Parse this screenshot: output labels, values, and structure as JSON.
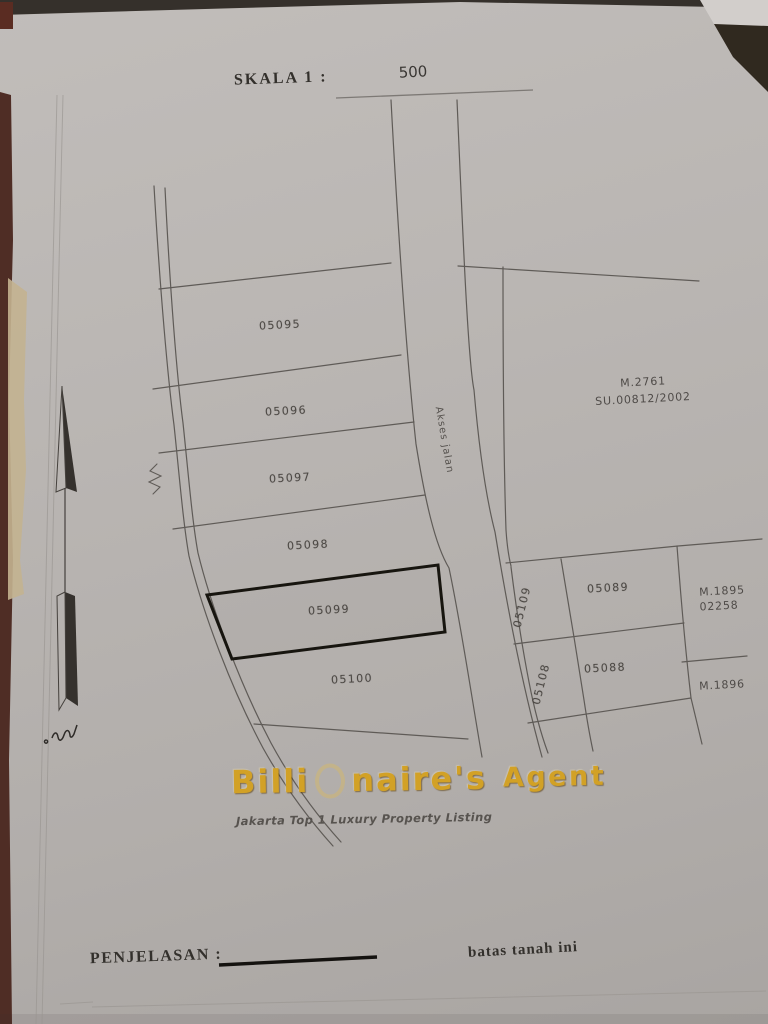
{
  "document": {
    "scale_label": "SKALA 1 :",
    "scale_value": "500",
    "legend_label": "PENJELASAN :",
    "legend_line_meaning": "batas tanah ini"
  },
  "map": {
    "road_label": "Akses jalan",
    "highlighted_plot": "05099",
    "plots": {
      "p05095": "05095",
      "p05096": "05096",
      "p05097": "05097",
      "p05098": "05098",
      "p05099": "05099",
      "p05100": "05100",
      "p05089": "05089",
      "p05088": "05088",
      "p05109": "05109",
      "p05108": "05108"
    },
    "references": {
      "m2761": "M.2761",
      "su2761": "SU.00812/2002",
      "m1895": "M.1895",
      "m1895_no": "02258",
      "m1896": "M.1896"
    }
  },
  "watermark": {
    "title": "Billionaire's Agent",
    "title_part1": "Billi",
    "title_part2": "naire's",
    "title_part3": "Agent",
    "subtitle": "Jakarta Top 1 Luxury Property Listing",
    "gold_color": "#d2a126"
  },
  "colors": {
    "paper": "#b7b3b0",
    "ink_line": "#5f5b57",
    "bold_boundary": "#17150f",
    "maroon_edge": "#4f2d25",
    "beige_edge": "#c3b290",
    "dark_top": "#332e29"
  }
}
